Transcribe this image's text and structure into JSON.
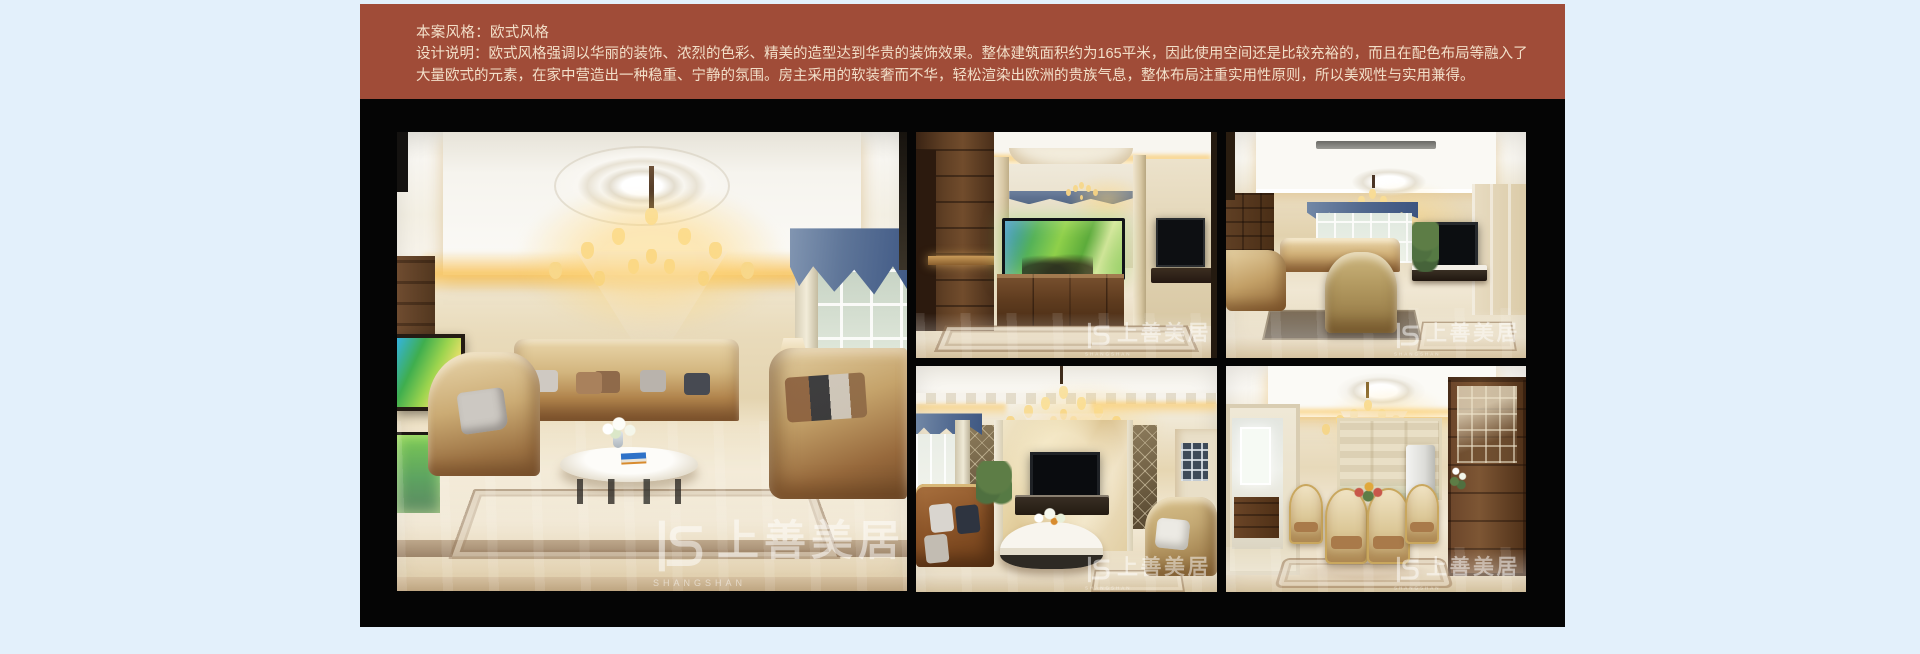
{
  "page": {
    "background_color": "#E3F0FB"
  },
  "header": {
    "background_color": "#A04C38",
    "text_color": "#F2DFC9",
    "style_title": "本案风格：欧式风格",
    "description": "设计说明：欧式风格强调以华丽的装饰、浓烈的色彩、精美的造型达到华贵的装饰效果。整体建筑面积约为165平米，因此使用空间还是比较充裕的，而且在配色布局等融入了大量欧式的元素，在家中营造出一种稳重、宁静的氛围。房主采用的软装奢而不华，轻松渲染出欧洲的贵族气息，整体布局注重实用性原则，所以美观性与实用兼得。"
  },
  "gallery": {
    "background_color": "#050505",
    "watermark": {
      "logo_text": "上善美居",
      "latin_line1": "SHANGSHAN",
      "latin_line2": "MEIJU"
    }
  }
}
